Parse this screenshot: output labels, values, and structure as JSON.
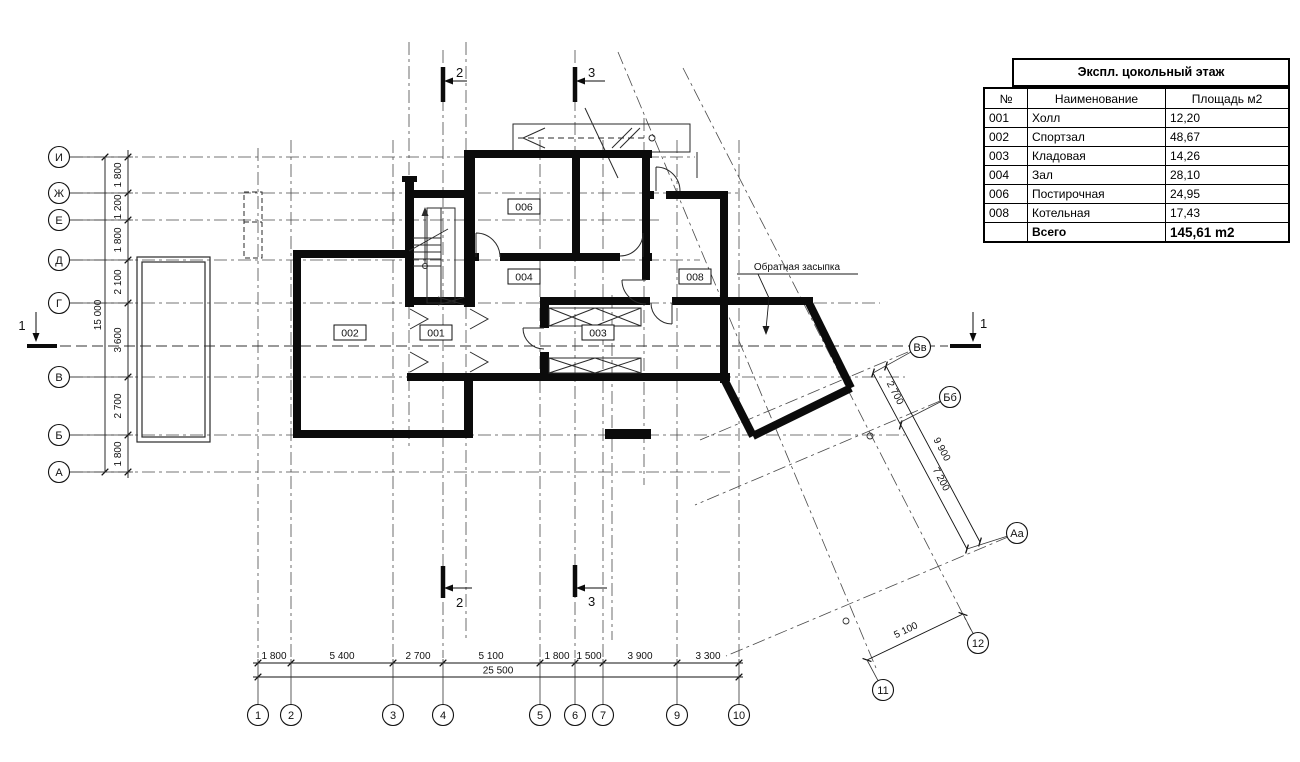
{
  "drawing": {
    "annotation_backfill": "Обратная засыпка"
  },
  "table": {
    "title": "Экспл. цокольный этаж",
    "columns": [
      "№",
      "Наименование",
      "Площадь м2"
    ],
    "rows": [
      [
        "001",
        "Холл",
        "12,20"
      ],
      [
        "002",
        "Спортзал",
        "48,67"
      ],
      [
        "003",
        "Кладовая",
        "14,26"
      ],
      [
        "004",
        "Зал",
        "28,10"
      ],
      [
        "006",
        "Постирочная",
        "24,95"
      ],
      [
        "008",
        "Котельная",
        "17,43"
      ]
    ],
    "total_label": "Всего",
    "total_value": "145,61 m2"
  },
  "axes": {
    "left": [
      {
        "label": "И",
        "y": 157
      },
      {
        "label": "Ж",
        "y": 193
      },
      {
        "label": "Е",
        "y": 220
      },
      {
        "label": "Д",
        "y": 260
      },
      {
        "label": "Г",
        "y": 303
      },
      {
        "label": "В",
        "y": 377
      },
      {
        "label": "Б",
        "y": 435
      },
      {
        "label": "А",
        "y": 472
      }
    ],
    "bottom": [
      {
        "label": "1",
        "x": 258
      },
      {
        "label": "2",
        "x": 291
      },
      {
        "label": "3",
        "x": 393
      },
      {
        "label": "4",
        "x": 443
      },
      {
        "label": "5",
        "x": 540
      },
      {
        "label": "6",
        "x": 575
      },
      {
        "label": "7",
        "x": 603
      },
      {
        "label": "9",
        "x": 677
      },
      {
        "label": "10",
        "x": 739
      }
    ],
    "diagonal": [
      {
        "label": "Вв",
        "x": 920,
        "y": 347,
        "tx": 873,
        "ty": 373
      },
      {
        "label": "Бб",
        "x": 950,
        "y": 397,
        "tx": 899,
        "ty": 423
      },
      {
        "label": "Аа",
        "x": 1017,
        "y": 533,
        "tx": 967,
        "ty": 549
      },
      {
        "label": "11",
        "x": 883,
        "y": 690,
        "tx": 867,
        "ty": 660
      },
      {
        "label": "12",
        "x": 978,
        "y": 643,
        "tx": 963,
        "ty": 614
      }
    ]
  },
  "dimensions": {
    "bottom_row1": {
      "y": 663,
      "ticks": [
        258,
        291,
        393,
        443,
        540,
        575,
        603,
        677,
        739
      ],
      "labels": [
        {
          "t": "1 800",
          "x": 274
        },
        {
          "t": "5 400",
          "x": 342
        },
        {
          "t": "2 700",
          "x": 418
        },
        {
          "t": "5 100",
          "x": 491
        },
        {
          "t": "1 800",
          "x": 557
        },
        {
          "t": "1 500",
          "x": 589
        },
        {
          "t": "3 900",
          "x": 640
        },
        {
          "t": "3 300",
          "x": 708
        }
      ]
    },
    "bottom_row2": {
      "y": 677,
      "ticks": [
        258,
        739
      ],
      "label": {
        "t": "25 500",
        "x": 498
      }
    },
    "left_row1": {
      "x": 128,
      "ticks": [
        157,
        193,
        220,
        260,
        303,
        377,
        435,
        472
      ],
      "labels": [
        {
          "t": "1 800",
          "y": 175
        },
        {
          "t": "1 200",
          "y": 207
        },
        {
          "t": "1 800",
          "y": 240
        },
        {
          "t": "2 100",
          "y": 282
        },
        {
          "t": "3 600",
          "y": 340
        },
        {
          "t": "2 700",
          "y": 406
        },
        {
          "t": "1 800",
          "y": 454
        }
      ]
    },
    "left_row2": {
      "x": 105,
      "ticks": [
        157,
        472
      ],
      "label": {
        "t": "15 000",
        "y": 315
      }
    },
    "diag_inner": {
      "x1": 873,
      "y1": 373,
      "x2": 967,
      "y2": 549,
      "tick_f": [
        0,
        0.295,
        1
      ],
      "labels": [
        {
          "t": "2 700",
          "f": 0.14
        },
        {
          "t": "7 200",
          "f": 0.63
        }
      ]
    },
    "diag_outer": {
      "x1": 886,
      "y1": 366,
      "x2": 980,
      "y2": 542,
      "tick_f": [
        0,
        1
      ],
      "labels": [
        {
          "t": "9 900",
          "f": 0.5
        }
      ]
    },
    "diag_5100": {
      "x1": 867,
      "y1": 660,
      "x2": 963,
      "y2": 614,
      "tick_f": [
        0,
        1
      ],
      "labels": [
        {
          "t": "5 100",
          "f": 0.45
        }
      ]
    }
  },
  "rooms": [
    {
      "id": "001",
      "x": 436,
      "y": 333
    },
    {
      "id": "002",
      "x": 350,
      "y": 333
    },
    {
      "id": "003",
      "x": 598,
      "y": 333
    },
    {
      "id": "004",
      "x": 524,
      "y": 277
    },
    {
      "id": "006",
      "x": 524,
      "y": 207
    },
    {
      "id": "008",
      "x": 695,
      "y": 277
    }
  ],
  "sections": [
    {
      "label": "1"
    },
    {
      "label": "1"
    },
    {
      "label": "2"
    },
    {
      "label": "3"
    },
    {
      "label": "2"
    },
    {
      "label": "3"
    }
  ],
  "grid": {
    "vertical": [
      [
        258,
        148,
        658
      ],
      [
        291,
        140,
        658
      ],
      [
        393,
        140,
        658
      ],
      [
        409,
        42,
        448
      ],
      [
        443,
        50,
        658
      ],
      [
        466,
        42,
        640
      ],
      [
        540,
        140,
        658
      ],
      [
        575,
        50,
        658
      ],
      [
        603,
        140,
        658
      ],
      [
        612,
        295,
        640
      ],
      [
        644,
        118,
        485
      ],
      [
        677,
        140,
        658
      ],
      [
        739,
        140,
        658
      ]
    ],
    "horizontal": [
      [
        157,
        70,
        695
      ],
      [
        193,
        70,
        742
      ],
      [
        220,
        70,
        660
      ],
      [
        260,
        70,
        700
      ],
      [
        303,
        70,
        880
      ],
      [
        377,
        70,
        905
      ],
      [
        435,
        70,
        905
      ],
      [
        472,
        70,
        730
      ]
    ],
    "section_cut": [
      346,
      60,
      948
    ],
    "diagonal": [
      [
        618,
        52,
        876,
        668
      ],
      [
        683,
        68,
        971,
        630
      ],
      [
        908,
        352,
        700,
        440
      ],
      [
        940,
        401,
        695,
        505
      ],
      [
        1008,
        537,
        726,
        656
      ]
    ],
    "node_circles": [
      [
        870,
        436
      ],
      [
        846,
        621
      ]
    ]
  }
}
